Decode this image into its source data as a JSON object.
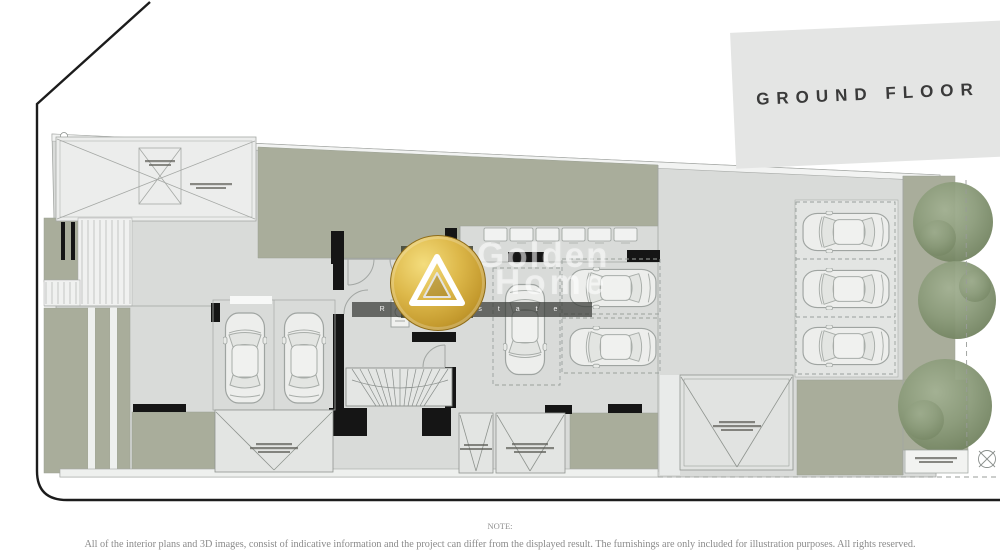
{
  "banner": {
    "label": "GROUND FLOOR"
  },
  "watermark": {
    "word1": "Golden",
    "word2": "Home",
    "tagline": "R e a l   E s t a t e"
  },
  "note": {
    "label": "NOTE:",
    "text": "All of the interior plans and 3D images, consist of indicative information and the project can differ from the displayed result. The furnishings are only included for illustration purposes. All rights reserved."
  },
  "plan": {
    "type": "architectural-floor-plan",
    "floor": "GROUND FLOOR",
    "colors": {
      "landscape_green": "#a9ad9b",
      "floor_gray": "#d9dbd9",
      "wall_black": "#151515",
      "ramp_white": "#ecedec",
      "banner_gray": "#e4e5e4",
      "gold": "#d8b245",
      "line_gray": "#a2a6a2",
      "tree_green": "#84956f"
    },
    "elements": {
      "cars": 8,
      "trees": 3,
      "storage_units": 6,
      "ramp_areas": 4,
      "stair_cores": 1
    }
  }
}
